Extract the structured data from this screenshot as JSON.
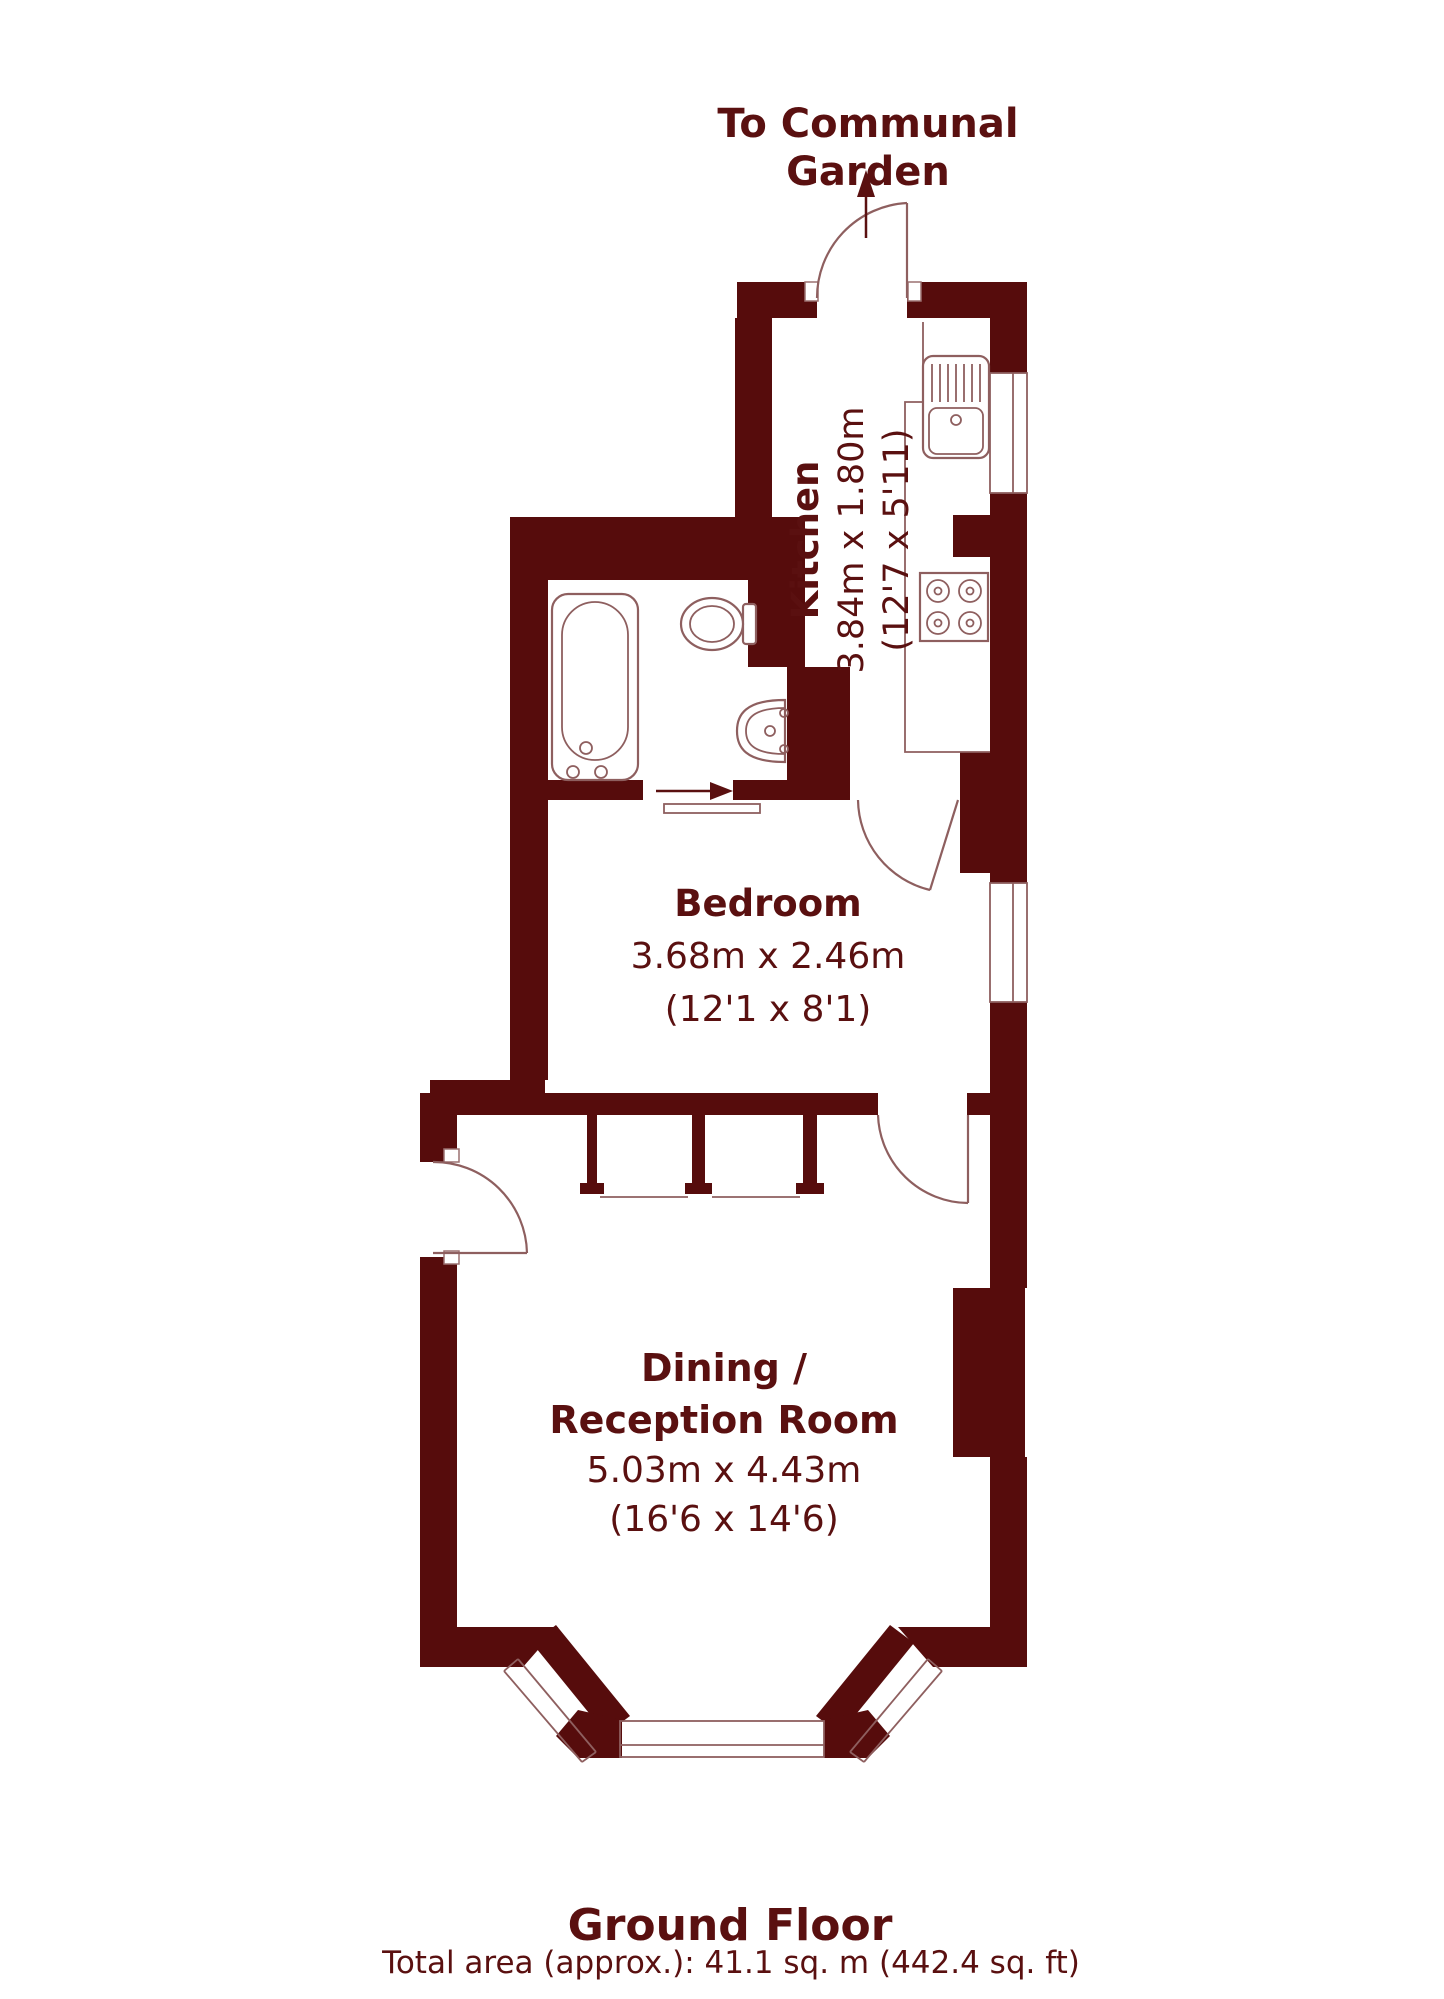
{
  "header": {
    "garden_label_line1": "To Communal",
    "garden_label_line2": "Garden"
  },
  "rooms": {
    "kitchen": {
      "name": "Kitchen",
      "dims_m": "3.84m x 1.80m",
      "dims_ft": "(12'7 x 5'11)"
    },
    "bedroom": {
      "name": "Bedroom",
      "dims_m": "3.68m x 2.46m",
      "dims_ft": "(12'1 x 8'1)"
    },
    "dining": {
      "name_line1": "Dining /",
      "name_line2": "Reception Room",
      "dims_m": "5.03m x 4.43m",
      "dims_ft": "(16'6 x 14'6)"
    }
  },
  "footer": {
    "floor_title": "Ground Floor",
    "total_area": "Total area (approx.): 41.1 sq. m (442.4 sq. ft)"
  },
  "icons": {
    "bathtub": "bathtub-icon",
    "toilet": "toilet-icon",
    "basin": "basin-icon",
    "sink": "kitchen-sink-icon",
    "hob": "hob-icon",
    "garden_arrow": "garden-direction-arrow-icon",
    "slide_arrow": "sliding-door-arrow-icon"
  },
  "colors": {
    "wall": "#560C0C",
    "fixture_line": "#8E5F5F",
    "text": "#5A1010",
    "background": "#FFFFFF"
  }
}
